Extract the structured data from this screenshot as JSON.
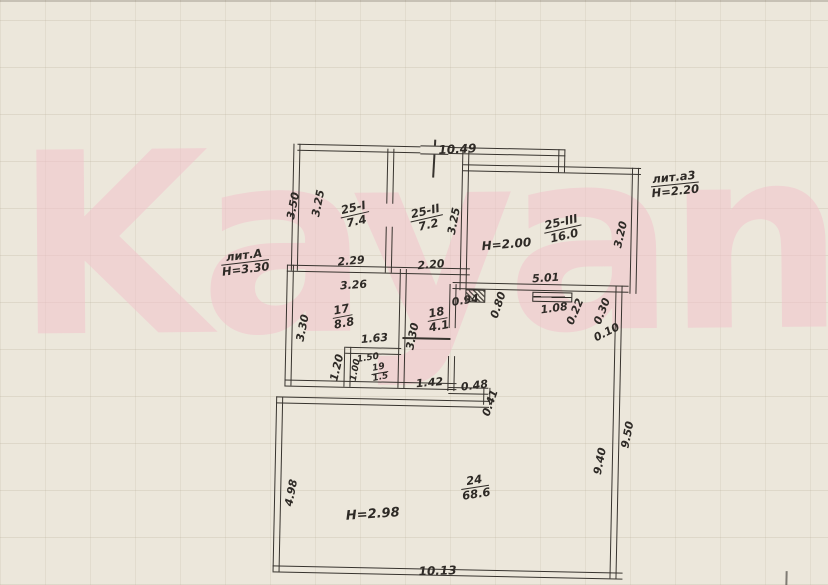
{
  "watermark": {
    "text": "Kayan",
    "color": "#f2c3cc"
  },
  "plan": {
    "buildings": {
      "main_label": "лит.А",
      "annex_label": "лит.а3"
    },
    "heights": {
      "main": "Н=3.30",
      "annex": "Н=2.20",
      "note_middle": "Н=2.00",
      "note_room24": "Н=2.98"
    },
    "rooms": {
      "r25_1": {
        "number": "25-I",
        "area": "7.4"
      },
      "r25_2": {
        "number": "25-II",
        "area": "7.2"
      },
      "r25_3": {
        "number": "25-III",
        "area": "16.0"
      },
      "r17": {
        "number": "17",
        "area": "8.8"
      },
      "r18": {
        "number": "18",
        "area": "4.1"
      },
      "r19": {
        "number": "19",
        "area": "1.5"
      },
      "r24": {
        "number": "24",
        "area": "68.6"
      }
    },
    "dims": {
      "top_width": "10.49",
      "bottom_width": "10.13",
      "left_outer_height": "3.50",
      "room25_1_height": "3.25",
      "room25_2_height": "3.25",
      "room25_1_width": "2.29",
      "room25_2_width": "2.20",
      "room25_3_width": "5.01",
      "room25_3_height": "3.20",
      "room17_width": "3.26",
      "room17_height": "3.30",
      "room18_height": "3.30",
      "niche_width": "0.94",
      "niche_depth": "0.80",
      "window_width": "1.08",
      "wall_step_a": "0.22",
      "wall_step_b": "0.30",
      "wall_step_c": "0.10",
      "closet_offset": "1.63",
      "closet_left": "1.20",
      "closet_width": "1.50",
      "closet_height": "1.00",
      "passage_width": "1.42",
      "step_width": "0.48",
      "step_height": "0.41",
      "room24_left_height": "4.98",
      "room24_right_outer": "9.50",
      "room24_right_inner": "9.40"
    }
  }
}
